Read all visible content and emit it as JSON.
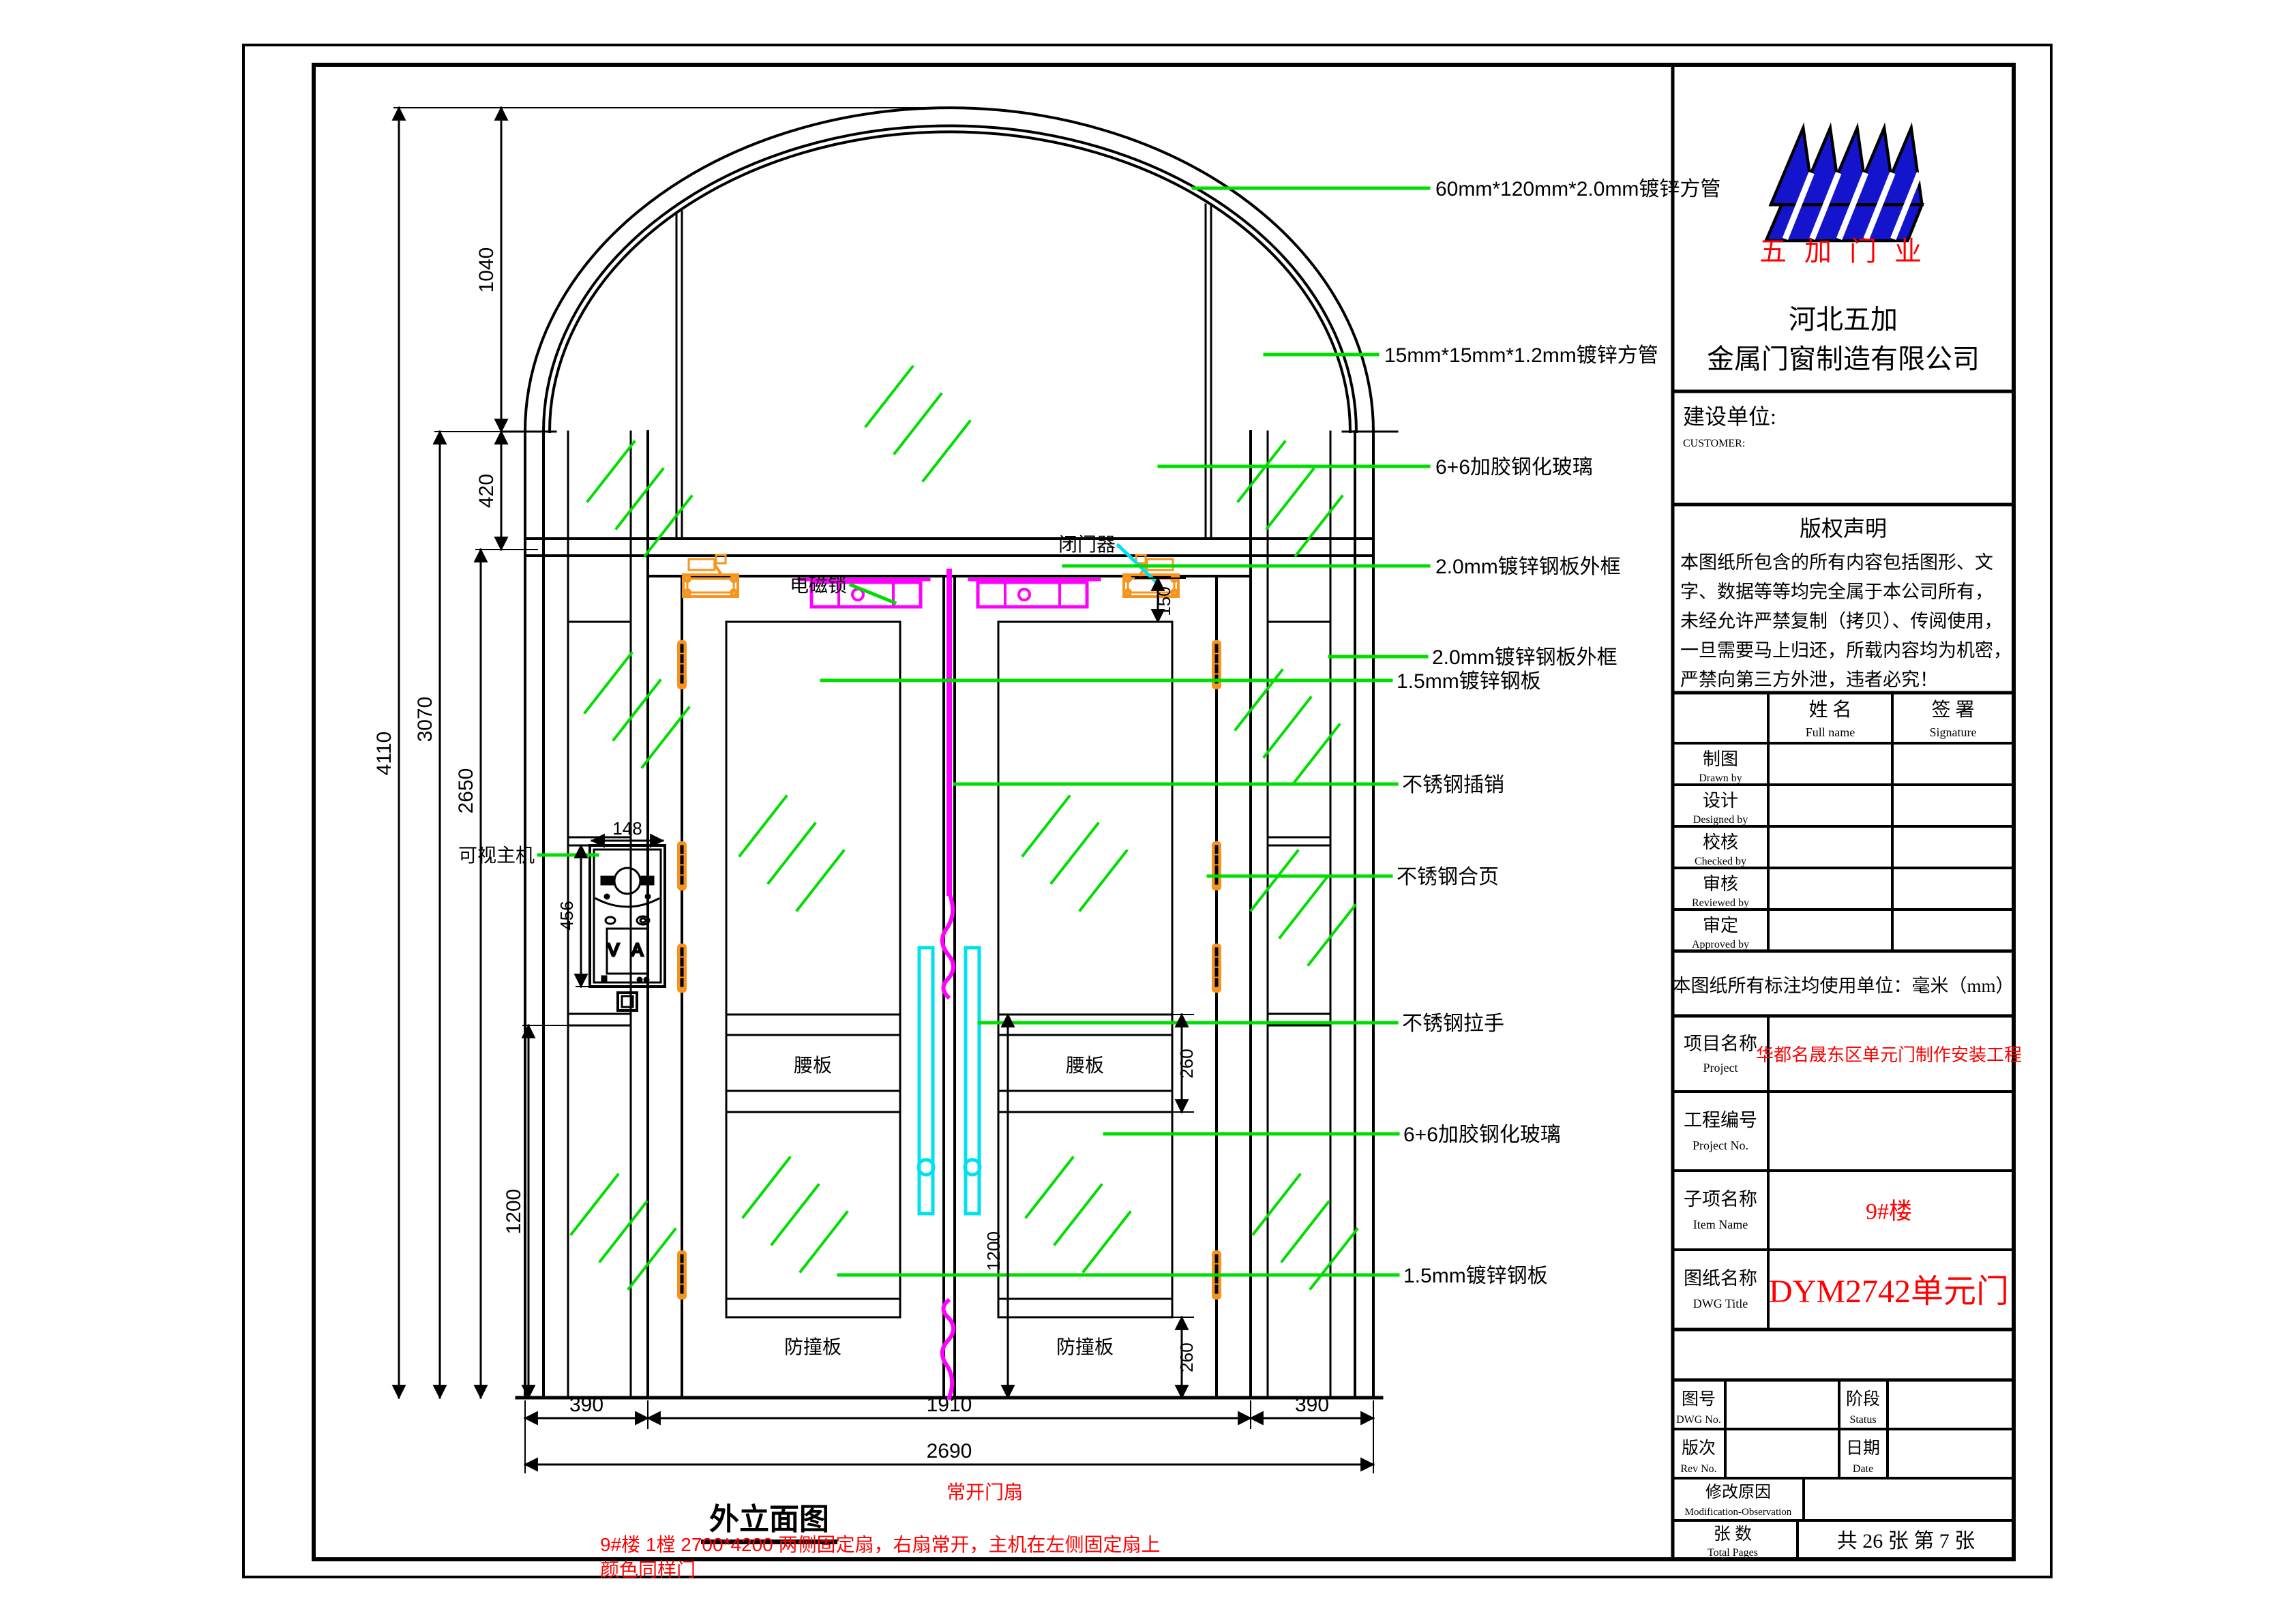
{
  "title_block": {
    "logo_brand": "五 加 门 业",
    "company_line1": "河北五加",
    "company_line2": "金属门窗制造有限公司",
    "customer_label": "建设单位:",
    "customer_label_en": "CUSTOMER:",
    "copyright_title": "版权声明",
    "copyright_lines": [
      "本图纸所包含的所有内容包括图形、文",
      "字、数据等等均完全属于本公司所有，",
      "未经允许严禁复制（拷贝）、传阅使用，",
      "一旦需要马上归还，所载内容均为机密，",
      "严禁向第三方外泄，违者必究！"
    ],
    "table": {
      "name_cn": "姓  名",
      "name_en": "Full name",
      "sign_cn": "签  署",
      "sign_en": "Signature",
      "rows": [
        {
          "cn": "制图",
          "en": "Drawn by"
        },
        {
          "cn": "设计",
          "en": "Designed by"
        },
        {
          "cn": "校核",
          "en": "Checked by"
        },
        {
          "cn": "审核",
          "en": "Reviewed by"
        },
        {
          "cn": "审定",
          "en": "Approved by"
        }
      ]
    },
    "units_note": "本图纸所有标注均使用单位：毫米（mm）",
    "project_label_cn": "项目名称",
    "project_label_en": "Project",
    "project_value": "华都名晟东区单元门制作安装工程",
    "project_no_label_cn": "工程编号",
    "project_no_label_en": "Project No.",
    "item_label_cn": "子项名称",
    "item_label_en": "Item Name",
    "item_value": "9#楼",
    "dwg_label_cn": "图纸名称",
    "dwg_label_en": "DWG Title",
    "dwg_value": "DYM2742单元门",
    "dwg_no_cn": "图号",
    "dwg_no_en": "DWG No.",
    "status_cn": "阶段",
    "status_en": "Status",
    "rev_cn": "版次",
    "rev_en": "Rev No.",
    "date_cn": "日期",
    "date_en": "Date",
    "mod_cn": "修改原因",
    "mod_en": "Modification-Observation",
    "pages_cn": "张    数",
    "pages_en": "Total Pages",
    "pages_value": "共 26 张 第 7 张"
  },
  "drawing": {
    "view_title": "外立面图",
    "leaf_note": "常开门扇",
    "note_line1": "9#楼 1樘 2700*4200   两侧固定扇，右扇常开，主机在左侧固定扇上",
    "note_line2": "颜色同样门",
    "labels": {
      "closer": "闭门器",
      "maglock": "电磁锁",
      "intercom": "可视主机",
      "waist": "腰板",
      "bump": "防撞板",
      "va": "V A"
    },
    "annotations": [
      "60mm*120mm*2.0mm镀锌方管",
      "15mm*15mm*1.2mm镀锌方管",
      "6+6加胶钢化玻璃",
      "2.0mm镀锌钢板外框",
      "2.0mm镀锌钢板外框",
      "1.5mm镀锌钢板",
      "不锈钢插销",
      "不锈钢合页",
      "不锈钢拉手",
      "6+6加胶钢化玻璃",
      "1.5mm镀锌钢板"
    ],
    "dimensions": {
      "d1040": "1040",
      "d420": "420",
      "d4110": "4110",
      "d3070": "3070",
      "d2650": "2650",
      "d1200_left": "1200",
      "d148": "148",
      "d456": "456",
      "d150": "150",
      "d260_top": "260",
      "d1200_door": "1200",
      "d260_bottom": "260",
      "d390_l": "390",
      "d1910": "1910",
      "d390_r": "390",
      "d2690": "2690"
    }
  },
  "colors": {
    "leader_green": "#00dd00",
    "hardware_orange": "#f7941d",
    "lock_magenta": "#ff00ff",
    "handle_cyan": "#00e0ee",
    "note_red": "#fe0000",
    "logo_blue": "#1414cc"
  }
}
